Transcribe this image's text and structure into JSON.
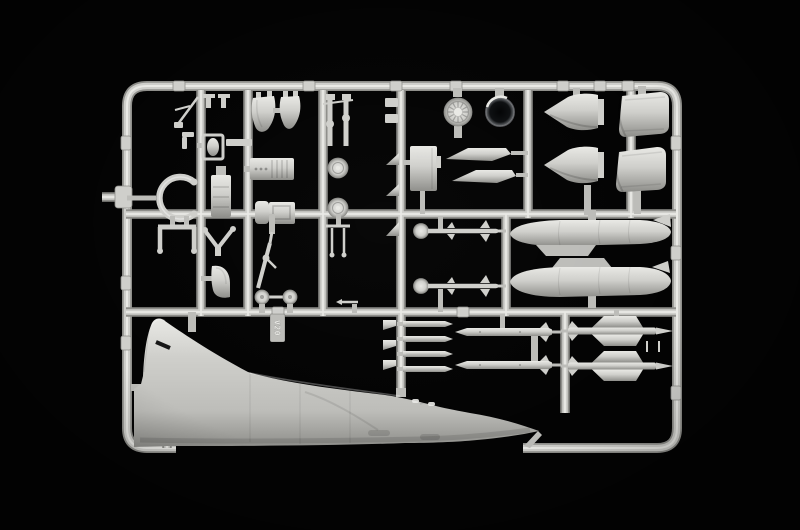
{
  "scene": {
    "subject": "model-kit-sprue-photo",
    "sprue_tag": "V20"
  },
  "colors": {
    "background": "#030303",
    "plastic": "#cfcfcb",
    "plastic_hi": "#e9e9e5",
    "plastic_mid": "#bdbdb9",
    "plastic_sh": "#8e8e8a",
    "ring_dark": "#0d0f11",
    "ring_rim": "#595c60"
  },
  "parts": [
    {
      "name": "fuselage-half-with-tail-fin",
      "count": 1
    },
    {
      "name": "nose-cone-half",
      "count": 2
    },
    {
      "name": "exhaust-nozzle-half",
      "count": 2
    },
    {
      "name": "drop-tank",
      "count": 2
    },
    {
      "name": "air-intake-half",
      "count": 2
    },
    {
      "name": "intake-ring",
      "count": 1
    },
    {
      "name": "spoked-wheel-hub",
      "count": 1
    },
    {
      "name": "main-wheel",
      "count": 2
    },
    {
      "name": "nose-wheel",
      "count": 2
    },
    {
      "name": "main-gear-strut",
      "count": 2
    },
    {
      "name": "nose-gear-leg",
      "count": 1
    },
    {
      "name": "cockpit-tub",
      "count": 1
    },
    {
      "name": "ejection-seat",
      "count": 1
    },
    {
      "name": "seat-frame",
      "count": 1
    },
    {
      "name": "canopy-frame",
      "count": 1
    },
    {
      "name": "windscreen",
      "count": 1
    },
    {
      "name": "gear-door",
      "count": 1
    },
    {
      "name": "ventral-fin",
      "count": 2
    },
    {
      "name": "air-scoop",
      "count": 3
    },
    {
      "name": "missile-rail",
      "count": 4
    },
    {
      "name": "magic-missile",
      "count": 2
    },
    {
      "name": "missile-body",
      "count": 2
    },
    {
      "name": "finned-missile",
      "count": 2
    },
    {
      "name": "small-fin",
      "count": 3
    },
    {
      "name": "pitot-probe",
      "count": 1
    },
    {
      "name": "gear-bay-frame",
      "count": 1
    },
    {
      "name": "hinge-pin",
      "count": 2
    },
    {
      "name": "trim-tab",
      "count": 1
    }
  ]
}
